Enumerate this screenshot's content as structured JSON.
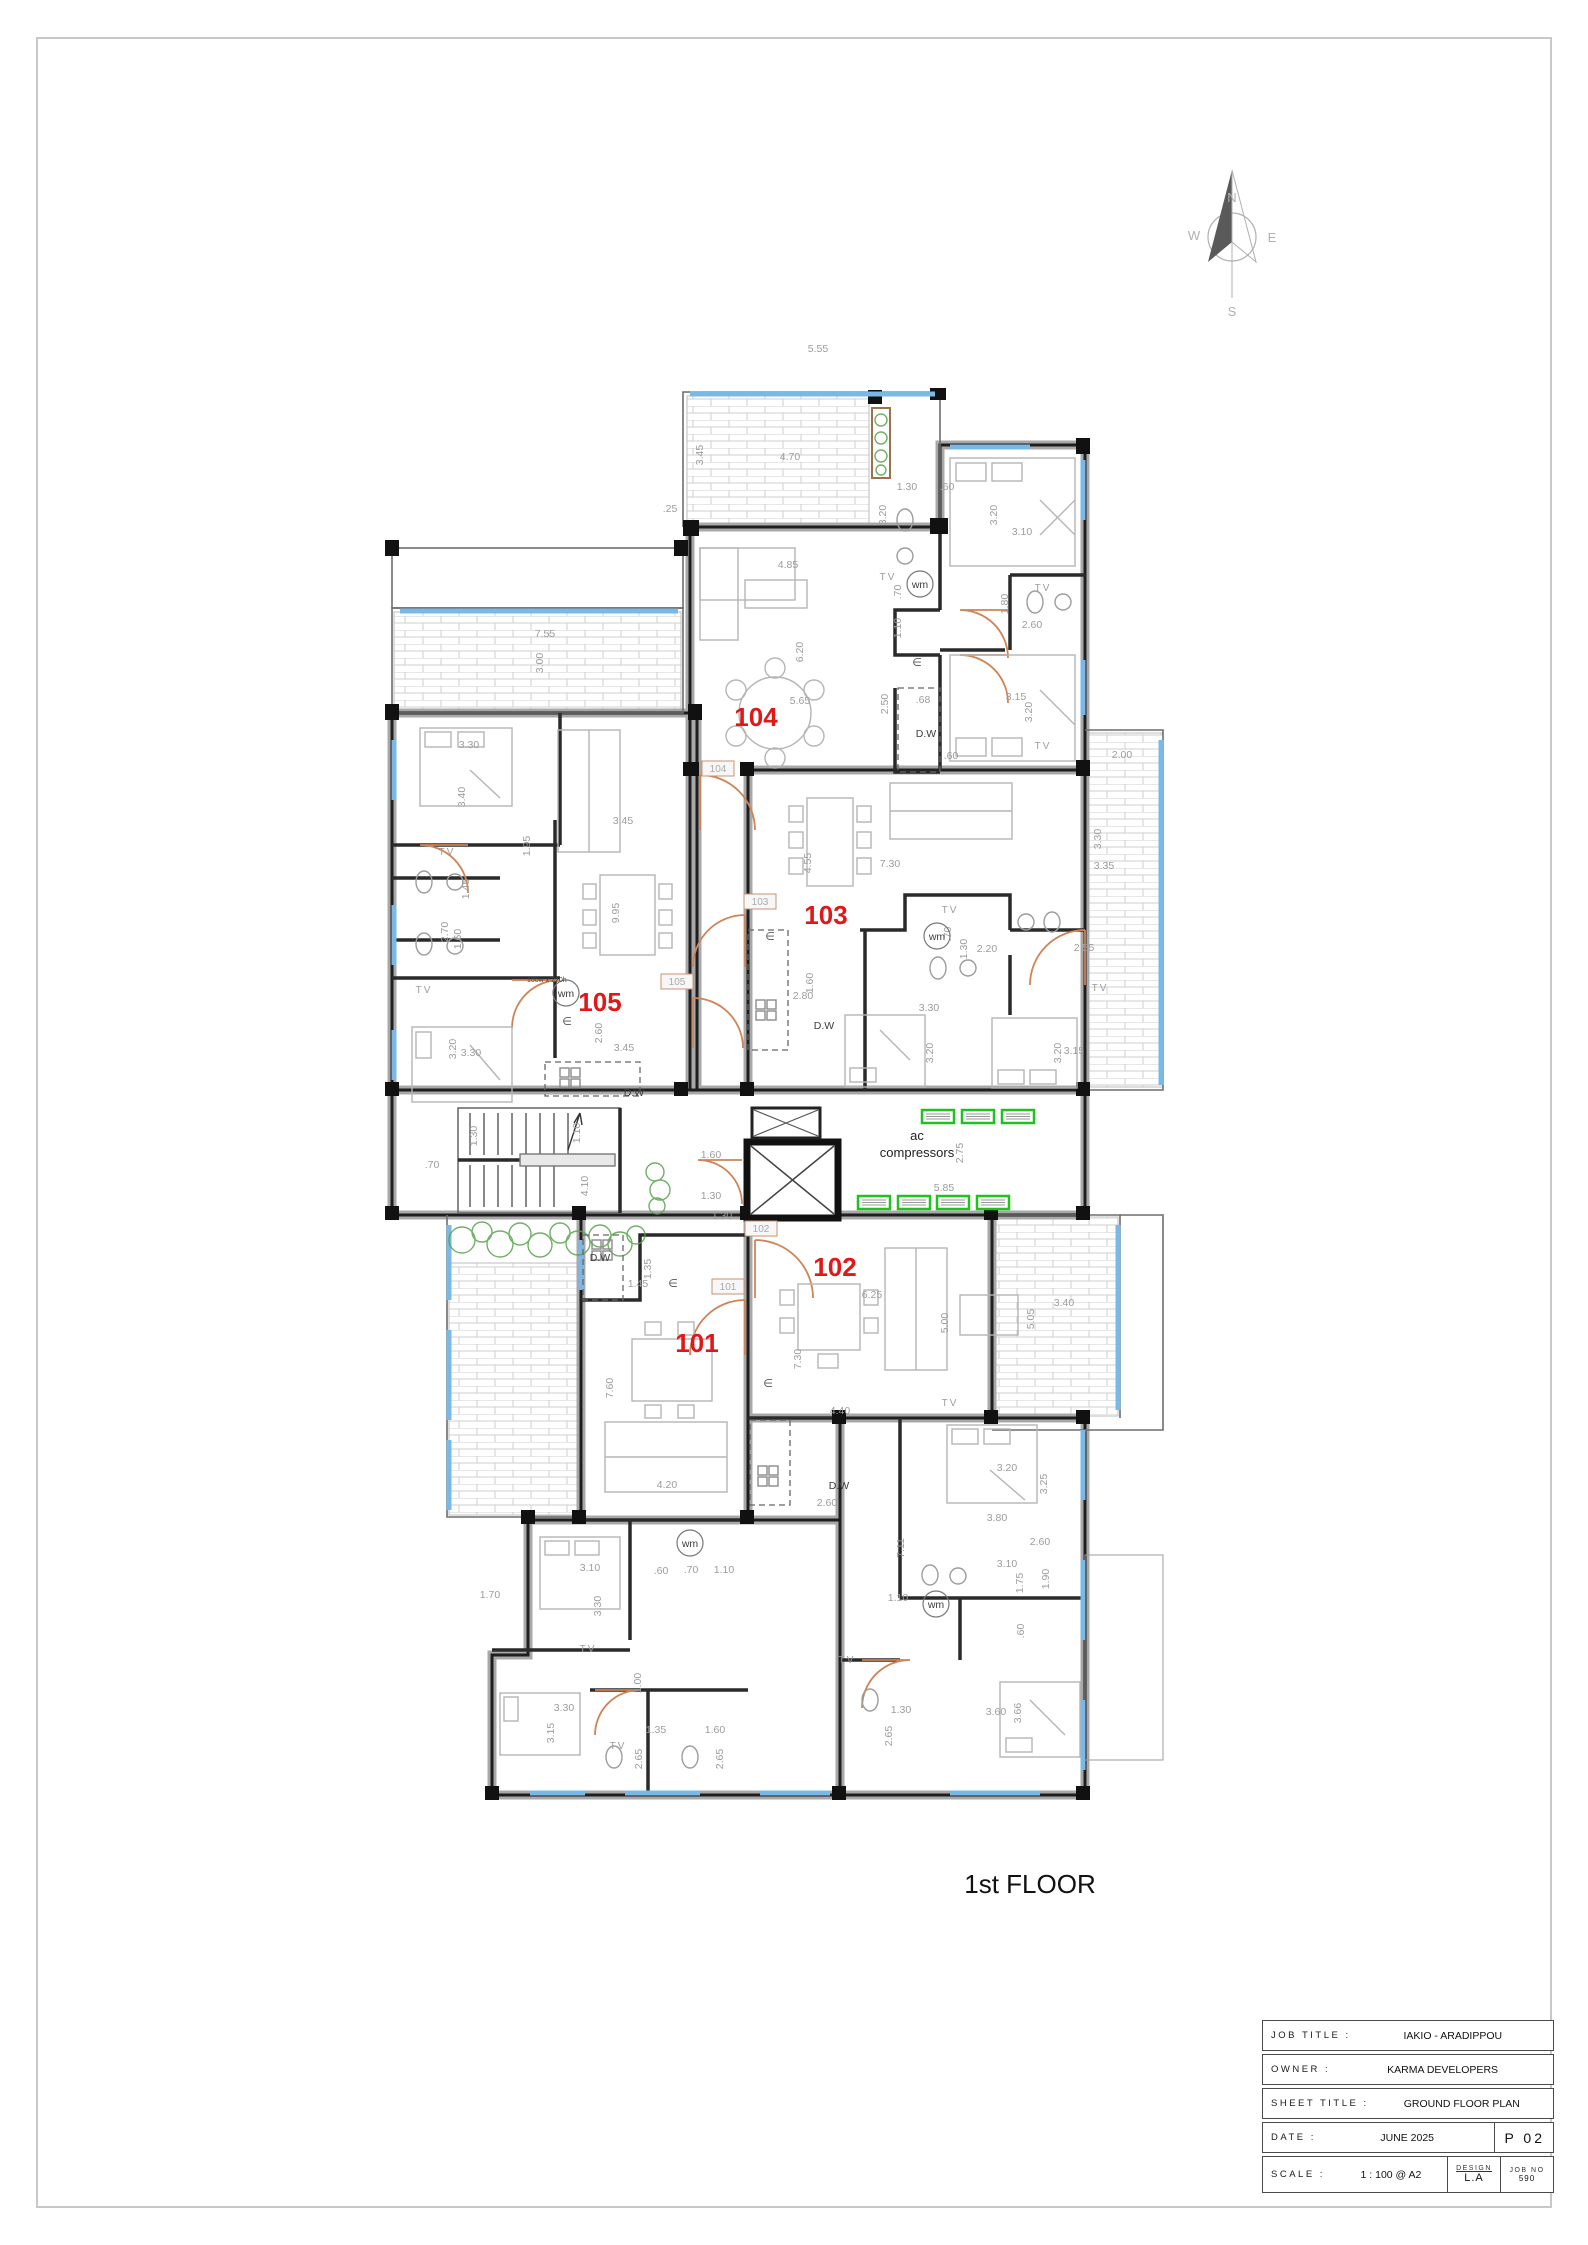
{
  "page": {
    "floor_label": "1st FLOOR"
  },
  "colors": {
    "apartment_number_red": "#e01818",
    "ac_unit_green": "#1ec41e",
    "door_swing_orange": "#cf8457",
    "window_blue": "#7ab8e8",
    "planting_green": "#57a34b"
  },
  "compass": {
    "n": "N",
    "e": "E",
    "s": "S",
    "w": "W"
  },
  "apartments": [
    {
      "number": "101",
      "x": 697,
      "y": 1352
    },
    {
      "number": "102",
      "x": 835,
      "y": 1276
    },
    {
      "number": "103",
      "x": 826,
      "y": 924
    },
    {
      "number": "104",
      "x": 756,
      "y": 726
    },
    {
      "number": "105",
      "x": 600,
      "y": 1011
    }
  ],
  "door_tags": [
    {
      "t": "104",
      "x": 718,
      "y": 772
    },
    {
      "t": "103",
      "x": 760,
      "y": 905
    },
    {
      "t": "105",
      "x": 677,
      "y": 985
    },
    {
      "t": "102",
      "x": 761,
      "y": 1232
    },
    {
      "t": "101",
      "x": 728,
      "y": 1290
    }
  ],
  "plan_labels": {
    "ac_line1": "ac",
    "ac_line2": "compressors",
    "ac_x": 917,
    "ac_y1": 1136,
    "ac_y2": 1152,
    "door_note": "100w x 220h",
    "door_note_x": 527,
    "door_note_y": 981
  },
  "fixtures": {
    "wm_label": "wm",
    "dw_label": "D.W",
    "tv_label": "TV",
    "euro_symbol": "∈",
    "wm_positions": [
      {
        "x": 920,
        "y": 588
      },
      {
        "x": 937,
        "y": 940
      },
      {
        "x": 566,
        "y": 997
      },
      {
        "x": 690,
        "y": 1547
      },
      {
        "x": 936,
        "y": 1608
      }
    ],
    "dw_positions": [
      {
        "x": 926,
        "y": 737
      },
      {
        "x": 824,
        "y": 1029
      },
      {
        "x": 600,
        "y": 1261
      },
      {
        "x": 839,
        "y": 1489
      },
      {
        "x": 634,
        "y": 1096
      }
    ],
    "tv_positions": [
      {
        "x": 888,
        "y": 580
      },
      {
        "x": 1043,
        "y": 591
      },
      {
        "x": 1043,
        "y": 749
      },
      {
        "x": 950,
        "y": 913
      },
      {
        "x": 1100,
        "y": 991
      },
      {
        "x": 447,
        "y": 855
      },
      {
        "x": 424,
        "y": 993
      },
      {
        "x": 588,
        "y": 1652
      },
      {
        "x": 847,
        "y": 1663
      },
      {
        "x": 950,
        "y": 1406
      },
      {
        "x": 618,
        "y": 1749
      }
    ],
    "euro_positions": [
      {
        "x": 917,
        "y": 666
      },
      {
        "x": 770,
        "y": 940
      },
      {
        "x": 567,
        "y": 1025
      },
      {
        "x": 673,
        "y": 1287
      },
      {
        "x": 768,
        "y": 1387
      }
    ]
  },
  "ac_units": {
    "positions": [
      {
        "x": 922,
        "y": 1110
      },
      {
        "x": 962,
        "y": 1110
      },
      {
        "x": 1002,
        "y": 1110
      },
      {
        "x": 858,
        "y": 1196
      },
      {
        "x": 898,
        "y": 1196
      },
      {
        "x": 937,
        "y": 1196
      },
      {
        "x": 977,
        "y": 1196
      }
    ]
  },
  "dimensions": {
    "items": [
      {
        "t": "5.55",
        "x": 818,
        "y": 352
      },
      {
        "t": "3.45",
        "x": 703,
        "y": 455,
        "r": 1
      },
      {
        "t": "4.70",
        "x": 790,
        "y": 460
      },
      {
        "t": ".25",
        "x": 670,
        "y": 512
      },
      {
        "t": "4.85",
        "x": 788,
        "y": 568
      },
      {
        "t": "6.20",
        "x": 803,
        "y": 652,
        "r": 1
      },
      {
        "t": "5.65",
        "x": 800,
        "y": 704
      },
      {
        "t": "1.30",
        "x": 907,
        "y": 490
      },
      {
        "t": ".60",
        "x": 947,
        "y": 490
      },
      {
        "t": "3.20",
        "x": 886,
        "y": 515,
        "r": 1
      },
      {
        "t": "3.20",
        "x": 997,
        "y": 515,
        "r": 1
      },
      {
        "t": "3.10",
        "x": 1022,
        "y": 535
      },
      {
        "t": ".70",
        "x": 901,
        "y": 592,
        "r": 1
      },
      {
        "t": "1.10",
        "x": 901,
        "y": 628,
        "r": 1
      },
      {
        "t": "1.80",
        "x": 1008,
        "y": 604,
        "r": 1
      },
      {
        "t": "2.60",
        "x": 1032,
        "y": 628
      },
      {
        "t": "2.50",
        "x": 888,
        "y": 704,
        "r": 1
      },
      {
        "t": ".68",
        "x": 923,
        "y": 703
      },
      {
        "t": "3.15",
        "x": 1016,
        "y": 700
      },
      {
        "t": "3.20",
        "x": 1032,
        "y": 712,
        "r": 1
      },
      {
        "t": ".60",
        "x": 951,
        "y": 759
      },
      {
        "t": "2.00",
        "x": 1122,
        "y": 758
      },
      {
        "t": "7.55",
        "x": 545,
        "y": 637
      },
      {
        "t": "3.00",
        "x": 543,
        "y": 663,
        "r": 1
      },
      {
        "t": "3.30",
        "x": 469,
        "y": 748
      },
      {
        "t": "3.40",
        "x": 465,
        "y": 797,
        "r": 1
      },
      {
        "t": "1.45",
        "x": 469,
        "y": 889,
        "r": 1
      },
      {
        "t": "2.70",
        "x": 448,
        "y": 932,
        "r": 1
      },
      {
        "t": "1.60",
        "x": 461,
        "y": 939,
        "r": 1
      },
      {
        "t": "1.95",
        "x": 530,
        "y": 846,
        "r": 1
      },
      {
        "t": "3.45",
        "x": 623,
        "y": 824
      },
      {
        "t": "9.95",
        "x": 619,
        "y": 913,
        "r": 1
      },
      {
        "t": "2.60",
        "x": 602,
        "y": 1033,
        "r": 1
      },
      {
        "t": "3.45",
        "x": 624,
        "y": 1051
      },
      {
        "t": "3.30",
        "x": 471,
        "y": 1056
      },
      {
        "t": "3.20",
        "x": 456,
        "y": 1049,
        "r": 1
      },
      {
        "t": "7.30",
        "x": 890,
        "y": 867
      },
      {
        "t": "4.55",
        "x": 811,
        "y": 863,
        "r": 1
      },
      {
        "t": "2.80",
        "x": 803,
        "y": 999
      },
      {
        "t": "1.60",
        "x": 813,
        "y": 983,
        "r": 1
      },
      {
        "t": "2.20",
        "x": 987,
        "y": 952
      },
      {
        "t": "1.30",
        "x": 967,
        "y": 949,
        "r": 1
      },
      {
        "t": ".70",
        "x": 951,
        "y": 934,
        "r": 1
      },
      {
        "t": "3.30",
        "x": 929,
        "y": 1011
      },
      {
        "t": "3.20",
        "x": 933,
        "y": 1053,
        "r": 1
      },
      {
        "t": "2.55",
        "x": 1084,
        "y": 951
      },
      {
        "t": "3.15",
        "x": 1074,
        "y": 1054
      },
      {
        "t": "3.20",
        "x": 1061,
        "y": 1053,
        "r": 1
      },
      {
        "t": "3.35",
        "x": 1104,
        "y": 869
      },
      {
        "t": "3.30",
        "x": 1101,
        "y": 839,
        "r": 1
      },
      {
        "t": "1.60",
        "x": 711,
        "y": 1158
      },
      {
        "t": "1.30",
        "x": 711,
        "y": 1199
      },
      {
        "t": "4.10",
        "x": 588,
        "y": 1186,
        "r": 1
      },
      {
        "t": "1.10",
        "x": 580,
        "y": 1133,
        "r": 1
      },
      {
        "t": "1.30",
        "x": 477,
        "y": 1136,
        "r": 1
      },
      {
        "t": ".70",
        "x": 432,
        "y": 1168
      },
      {
        "t": "5.85",
        "x": 944,
        "y": 1191
      },
      {
        "t": "2.75",
        "x": 963,
        "y": 1153,
        "r": 1
      },
      {
        "t": "1.30",
        "x": 722,
        "y": 1219
      },
      {
        "t": "1.45",
        "x": 638,
        "y": 1287
      },
      {
        "t": "1.35",
        "x": 651,
        "y": 1269,
        "r": 1
      },
      {
        "t": "6.25",
        "x": 872,
        "y": 1298
      },
      {
        "t": "7.30",
        "x": 801,
        "y": 1359,
        "r": 1
      },
      {
        "t": "5.00",
        "x": 948,
        "y": 1323,
        "r": 1
      },
      {
        "t": "4.40",
        "x": 840,
        "y": 1414
      },
      {
        "t": "3.40",
        "x": 1064,
        "y": 1306
      },
      {
        "t": "5.05",
        "x": 1034,
        "y": 1319,
        "r": 1
      },
      {
        "t": "7.60",
        "x": 613,
        "y": 1388,
        "r": 1
      },
      {
        "t": "4.20",
        "x": 667,
        "y": 1488
      },
      {
        "t": "3.20",
        "x": 1007,
        "y": 1471
      },
      {
        "t": "3.25",
        "x": 1047,
        "y": 1484,
        "r": 1
      },
      {
        "t": "2.60",
        "x": 827,
        "y": 1506
      },
      {
        "t": "3.80",
        "x": 997,
        "y": 1521
      },
      {
        "t": "3.10",
        "x": 1007,
        "y": 1567
      },
      {
        "t": "1.75",
        "x": 1023,
        "y": 1583,
        "r": 1
      },
      {
        "t": "1.90",
        "x": 1049,
        "y": 1579,
        "r": 1
      },
      {
        "t": "7.11",
        "x": 904,
        "y": 1548,
        "r": 1
      },
      {
        "t": "1.70",
        "x": 490,
        "y": 1598
      },
      {
        "t": "3.10",
        "x": 590,
        "y": 1571
      },
      {
        "t": "3.30",
        "x": 601,
        "y": 1606,
        "r": 1
      },
      {
        "t": ".60",
        "x": 661,
        "y": 1574
      },
      {
        "t": ".70",
        "x": 691,
        "y": 1573
      },
      {
        "t": "1.10",
        "x": 724,
        "y": 1573
      },
      {
        "t": "1.00",
        "x": 641,
        "y": 1683,
        "r": 1
      },
      {
        "t": "3.30",
        "x": 564,
        "y": 1711
      },
      {
        "t": "3.15",
        "x": 554,
        "y": 1733,
        "r": 1
      },
      {
        "t": "1.35",
        "x": 656,
        "y": 1733
      },
      {
        "t": "1.60",
        "x": 715,
        "y": 1733
      },
      {
        "t": "2.65",
        "x": 642,
        "y": 1759,
        "r": 1
      },
      {
        "t": "2.65",
        "x": 723,
        "y": 1759,
        "r": 1
      },
      {
        "t": "1.10",
        "x": 898,
        "y": 1601
      },
      {
        "t": "1.30",
        "x": 901,
        "y": 1713
      },
      {
        "t": "2.65",
        "x": 892,
        "y": 1736,
        "r": 1
      },
      {
        "t": "3.60",
        "x": 996,
        "y": 1715
      },
      {
        "t": "3.66",
        "x": 1021,
        "y": 1713,
        "r": 1
      },
      {
        "t": ".60",
        "x": 1024,
        "y": 1631,
        "r": 1
      },
      {
        "t": "2.60",
        "x": 1040,
        "y": 1545
      }
    ]
  },
  "title_block": {
    "rows": [
      {
        "label": "JOB TITLE :",
        "value": "IAKIO - ARADIPPOU"
      },
      {
        "label": "OWNER :",
        "value": "KARMA DEVELOPERS"
      },
      {
        "label": "SHEET TITLE :",
        "value": "GROUND FLOOR PLAN"
      },
      {
        "label": "DATE :",
        "value": "JUNE 2025"
      },
      {
        "label": "SCALE :",
        "value": "1 : 100 @ A2"
      }
    ],
    "sheet_no": "P 02",
    "design_label": "DESIGN",
    "design_value": "L.A",
    "job_no_label": "JOB NO",
    "job_no_value": "590"
  }
}
